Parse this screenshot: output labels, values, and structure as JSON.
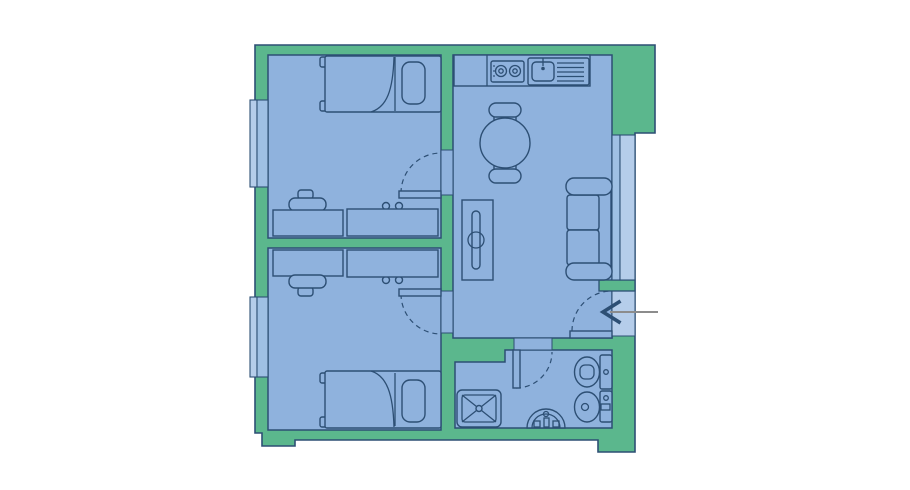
{
  "title": "apartment-floor-plan",
  "colors": {
    "background": "#ffffff",
    "wall": "#5bb78d",
    "floor": "#8fb2dd",
    "line": "#2d4f74",
    "window": "#b5cdea",
    "window_frame": "#9fc0e4",
    "arrow_line": "#8c8c8c",
    "arrow_head": "#2d4f74"
  },
  "rooms": [
    {
      "name": "bedroom-top-left",
      "furniture": [
        "single-bed",
        "pillow",
        "desk",
        "dressing-table",
        "chair",
        "window"
      ]
    },
    {
      "name": "bedroom-bottom-left",
      "furniture": [
        "single-bed",
        "pillow",
        "desk",
        "dressing-table",
        "chair",
        "window"
      ]
    },
    {
      "name": "living-kitchen",
      "furniture": [
        "kitchen-counter",
        "stove-two-burners",
        "sink-with-drainboard",
        "round-dining-table",
        "two-chairs",
        "radiator",
        "sofa",
        "window"
      ]
    },
    {
      "name": "bathroom",
      "furniture": [
        "shower",
        "washbasin",
        "toilet",
        "bidet"
      ]
    }
  ],
  "doors": [
    {
      "name": "bedroom-top-door",
      "type": "swing"
    },
    {
      "name": "bedroom-bottom-door",
      "type": "swing"
    },
    {
      "name": "bathroom-door",
      "type": "swing"
    },
    {
      "name": "entrance-door",
      "type": "swing",
      "marker": "entrance-arrow"
    }
  ]
}
